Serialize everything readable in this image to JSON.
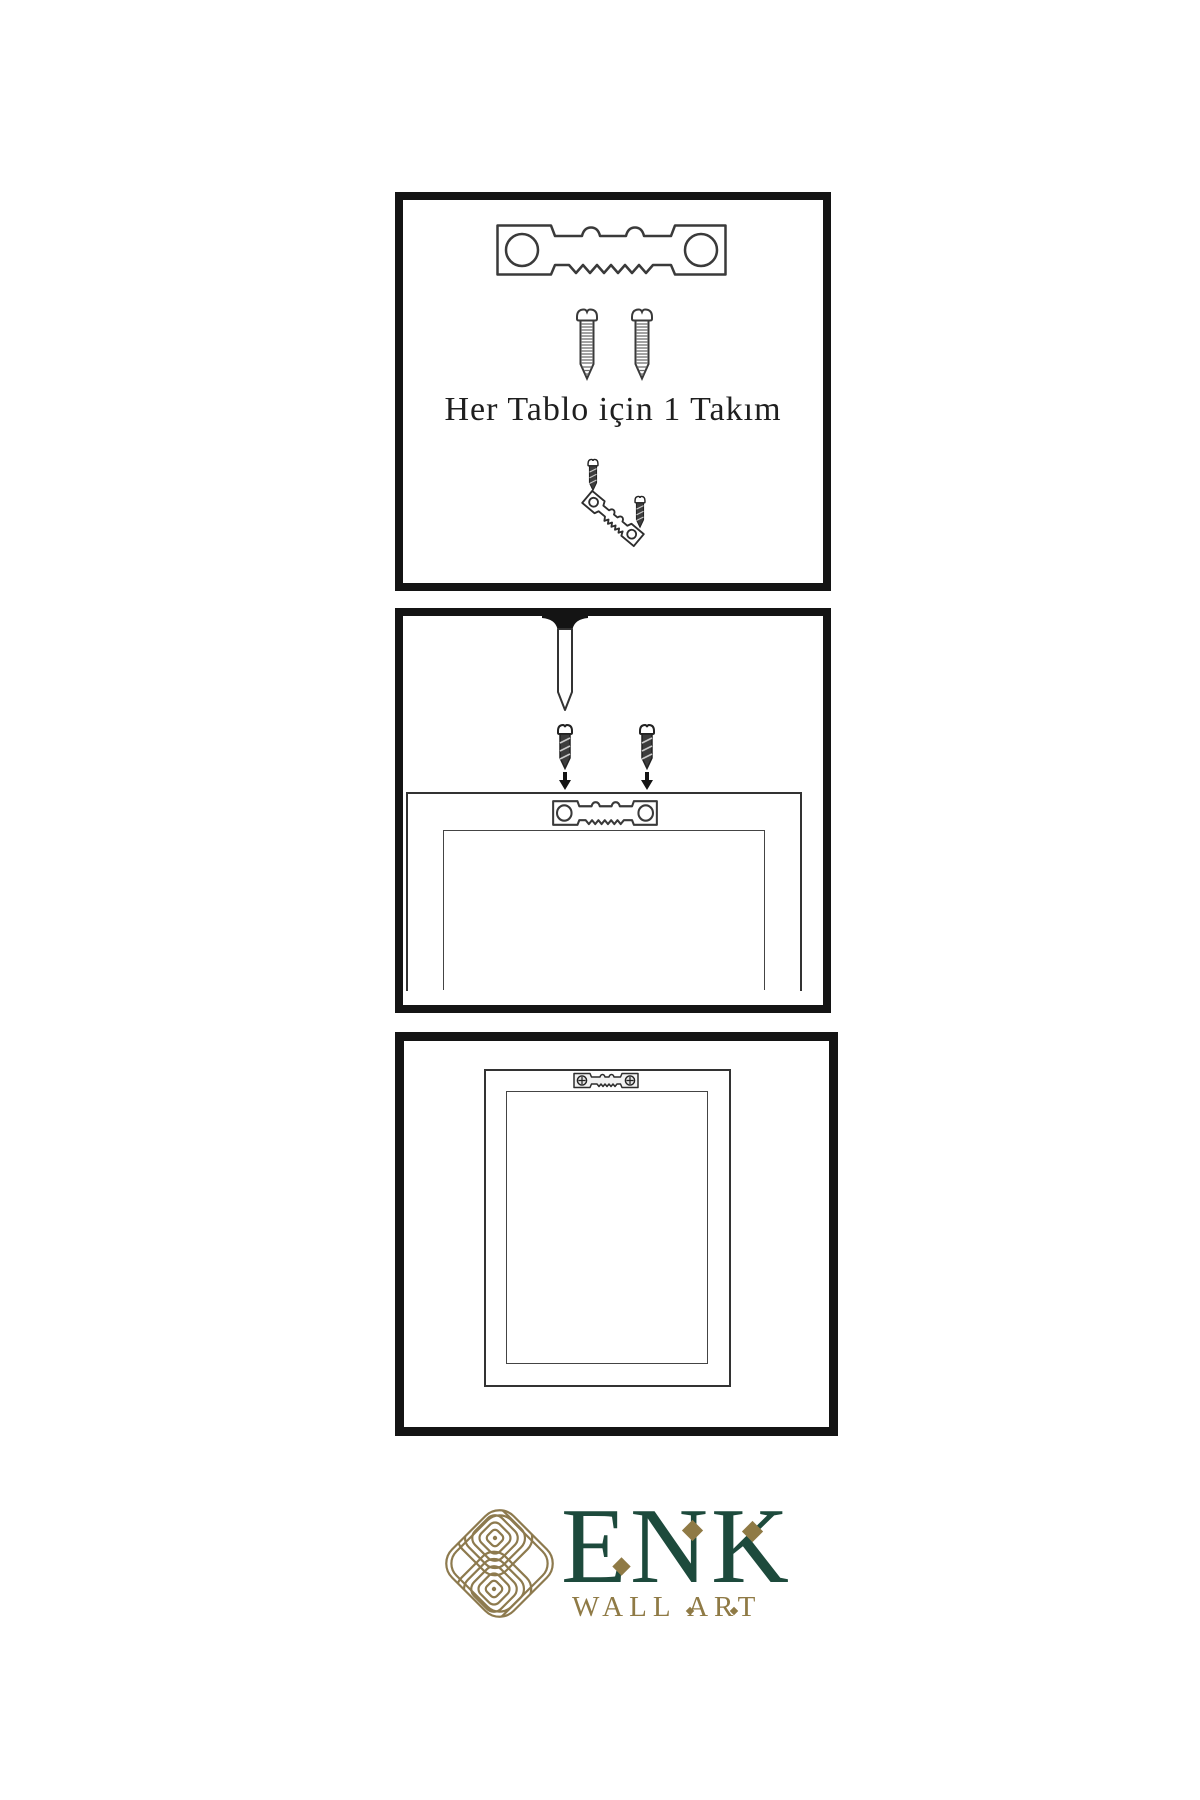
{
  "instructions": {
    "step1_caption": "Her Tablo için 1 Takım"
  },
  "logo": {
    "brand": "ENK",
    "subtitle": "WALL ART",
    "knot_icon": "interlocking-knot-icon"
  },
  "colors": {
    "panel_border": "#141414",
    "line_art": "#3a3a3a",
    "brand_green": "#1d4a3c",
    "brand_gold": "#8f7a45",
    "knot_gold": "#8d7a4e",
    "caption_text": "#1f1f1f"
  },
  "panels": [
    {
      "step": 1,
      "name": "hardware-kit",
      "icons": [
        "sawtooth-hanger-icon",
        "screw-icon",
        "screw-icon",
        "screw-into-hanger-demo-icon"
      ]
    },
    {
      "step": 2,
      "name": "attach-hanger-to-frame",
      "icons": [
        "wall-nail-icon",
        "dark-screw-icon",
        "dark-screw-icon",
        "down-arrow-icon",
        "down-arrow-icon",
        "frame-back-outline",
        "sawtooth-hanger-icon"
      ]
    },
    {
      "step": 3,
      "name": "frame-hung-on-wall",
      "icons": [
        "frame-back-outline",
        "installed-sawtooth-hanger-icon"
      ]
    }
  ]
}
